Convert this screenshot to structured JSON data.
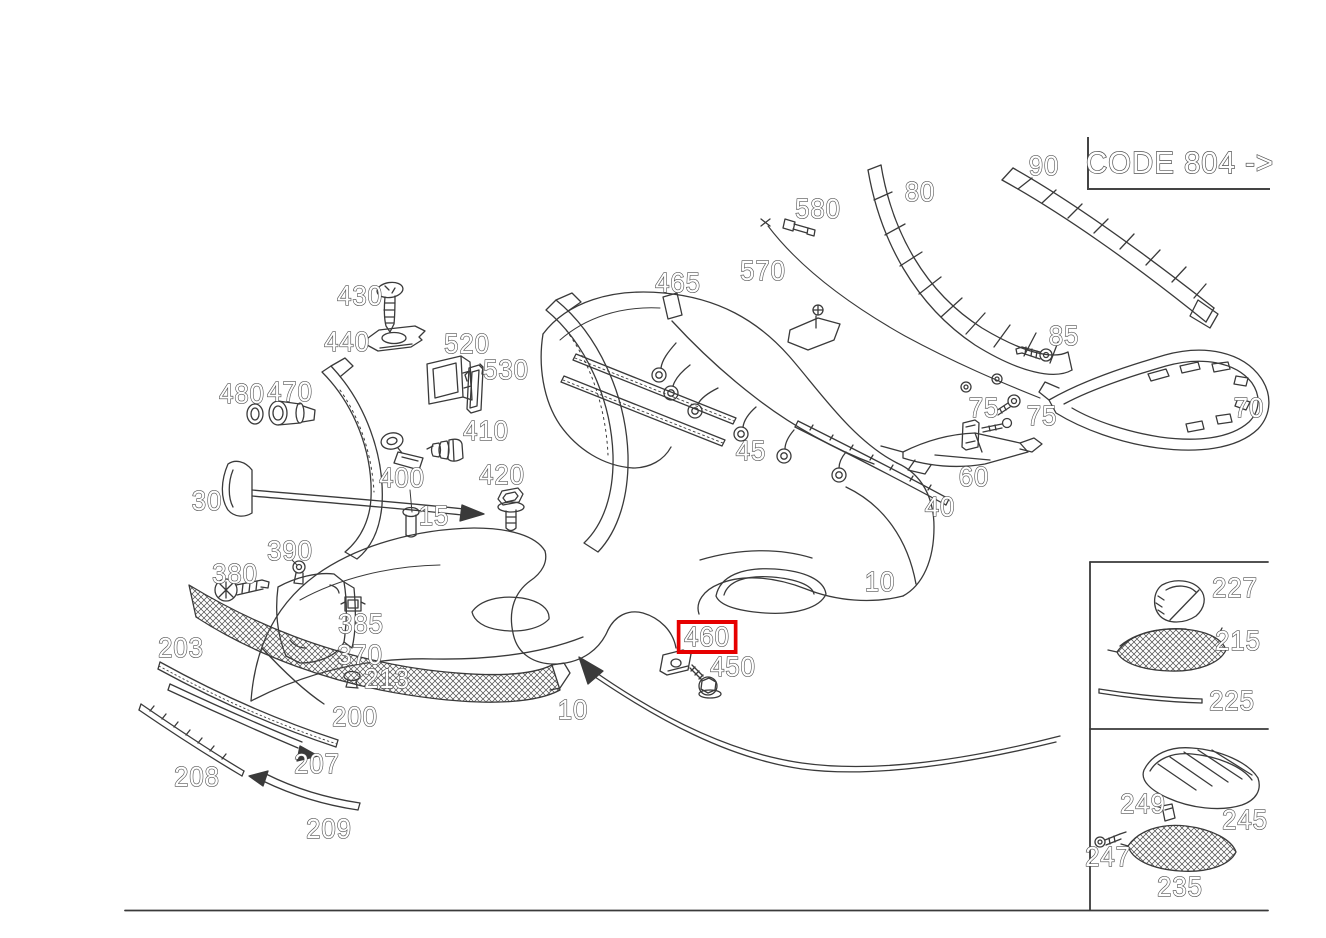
{
  "diagram": {
    "code_label": "CODE 804 ->",
    "line_color": "#3a3a3a",
    "label_color": "#4f4f4f",
    "highlight_color": "#e60000",
    "highlighted_part": "460",
    "labels": [
      {
        "id": "430",
        "text": "430",
        "x": 360,
        "y": 296
      },
      {
        "id": "440",
        "text": "440",
        "x": 347,
        "y": 342
      },
      {
        "id": "520",
        "text": "520",
        "x": 467,
        "y": 344
      },
      {
        "id": "530",
        "text": "530",
        "x": 506,
        "y": 370
      },
      {
        "id": "480",
        "text": "480",
        "x": 242,
        "y": 394
      },
      {
        "id": "470",
        "text": "470",
        "x": 290,
        "y": 392
      },
      {
        "id": "410",
        "text": "410",
        "x": 486,
        "y": 431
      },
      {
        "id": "400",
        "text": "400",
        "x": 402,
        "y": 478
      },
      {
        "id": "420",
        "text": "420",
        "x": 502,
        "y": 475
      },
      {
        "id": "15",
        "text": "15",
        "x": 434,
        "y": 516
      },
      {
        "id": "30",
        "text": "30",
        "x": 207,
        "y": 501
      },
      {
        "id": "390",
        "text": "390",
        "x": 290,
        "y": 551
      },
      {
        "id": "380",
        "text": "380",
        "x": 235,
        "y": 574
      },
      {
        "id": "385",
        "text": "385",
        "x": 361,
        "y": 624
      },
      {
        "id": "370",
        "text": "370",
        "x": 360,
        "y": 655
      },
      {
        "id": "203",
        "text": "203",
        "x": 181,
        "y": 648
      },
      {
        "id": "213",
        "text": "213",
        "x": 387,
        "y": 679
      },
      {
        "id": "200",
        "text": "200",
        "x": 355,
        "y": 717
      },
      {
        "id": "207",
        "text": "207",
        "x": 317,
        "y": 764
      },
      {
        "id": "208",
        "text": "208",
        "x": 197,
        "y": 777
      },
      {
        "id": "209",
        "text": "209",
        "x": 329,
        "y": 829
      },
      {
        "id": "10-left",
        "text": "10",
        "x": 573,
        "y": 710
      },
      {
        "id": "10-right",
        "text": "10",
        "x": 880,
        "y": 582
      },
      {
        "id": "460",
        "text": "460",
        "x": 707,
        "y": 637,
        "highlighted": true
      },
      {
        "id": "450",
        "text": "450",
        "x": 733,
        "y": 667
      },
      {
        "id": "465",
        "text": "465",
        "x": 678,
        "y": 283
      },
      {
        "id": "570",
        "text": "570",
        "x": 763,
        "y": 271
      },
      {
        "id": "580",
        "text": "580",
        "x": 818,
        "y": 209
      },
      {
        "id": "80",
        "text": "80",
        "x": 920,
        "y": 192
      },
      {
        "id": "90",
        "text": "90",
        "x": 1044,
        "y": 166
      },
      {
        "id": "85",
        "text": "85",
        "x": 1064,
        "y": 336
      },
      {
        "id": "75-left",
        "text": "75",
        "x": 984,
        "y": 408
      },
      {
        "id": "75-right",
        "text": "75",
        "x": 1042,
        "y": 416
      },
      {
        "id": "70",
        "text": "70",
        "x": 1249,
        "y": 408
      },
      {
        "id": "45",
        "text": "45",
        "x": 751,
        "y": 451
      },
      {
        "id": "60",
        "text": "60",
        "x": 974,
        "y": 477
      },
      {
        "id": "40",
        "text": "40",
        "x": 940,
        "y": 507
      },
      {
        "id": "227",
        "text": "227",
        "x": 1235,
        "y": 588
      },
      {
        "id": "215",
        "text": "215",
        "x": 1238,
        "y": 641
      },
      {
        "id": "225",
        "text": "225",
        "x": 1232,
        "y": 701
      },
      {
        "id": "245",
        "text": "245",
        "x": 1245,
        "y": 820
      },
      {
        "id": "249",
        "text": "249",
        "x": 1143,
        "y": 804
      },
      {
        "id": "247",
        "text": "247",
        "x": 1108,
        "y": 857
      },
      {
        "id": "235",
        "text": "235",
        "x": 1180,
        "y": 887
      }
    ]
  }
}
